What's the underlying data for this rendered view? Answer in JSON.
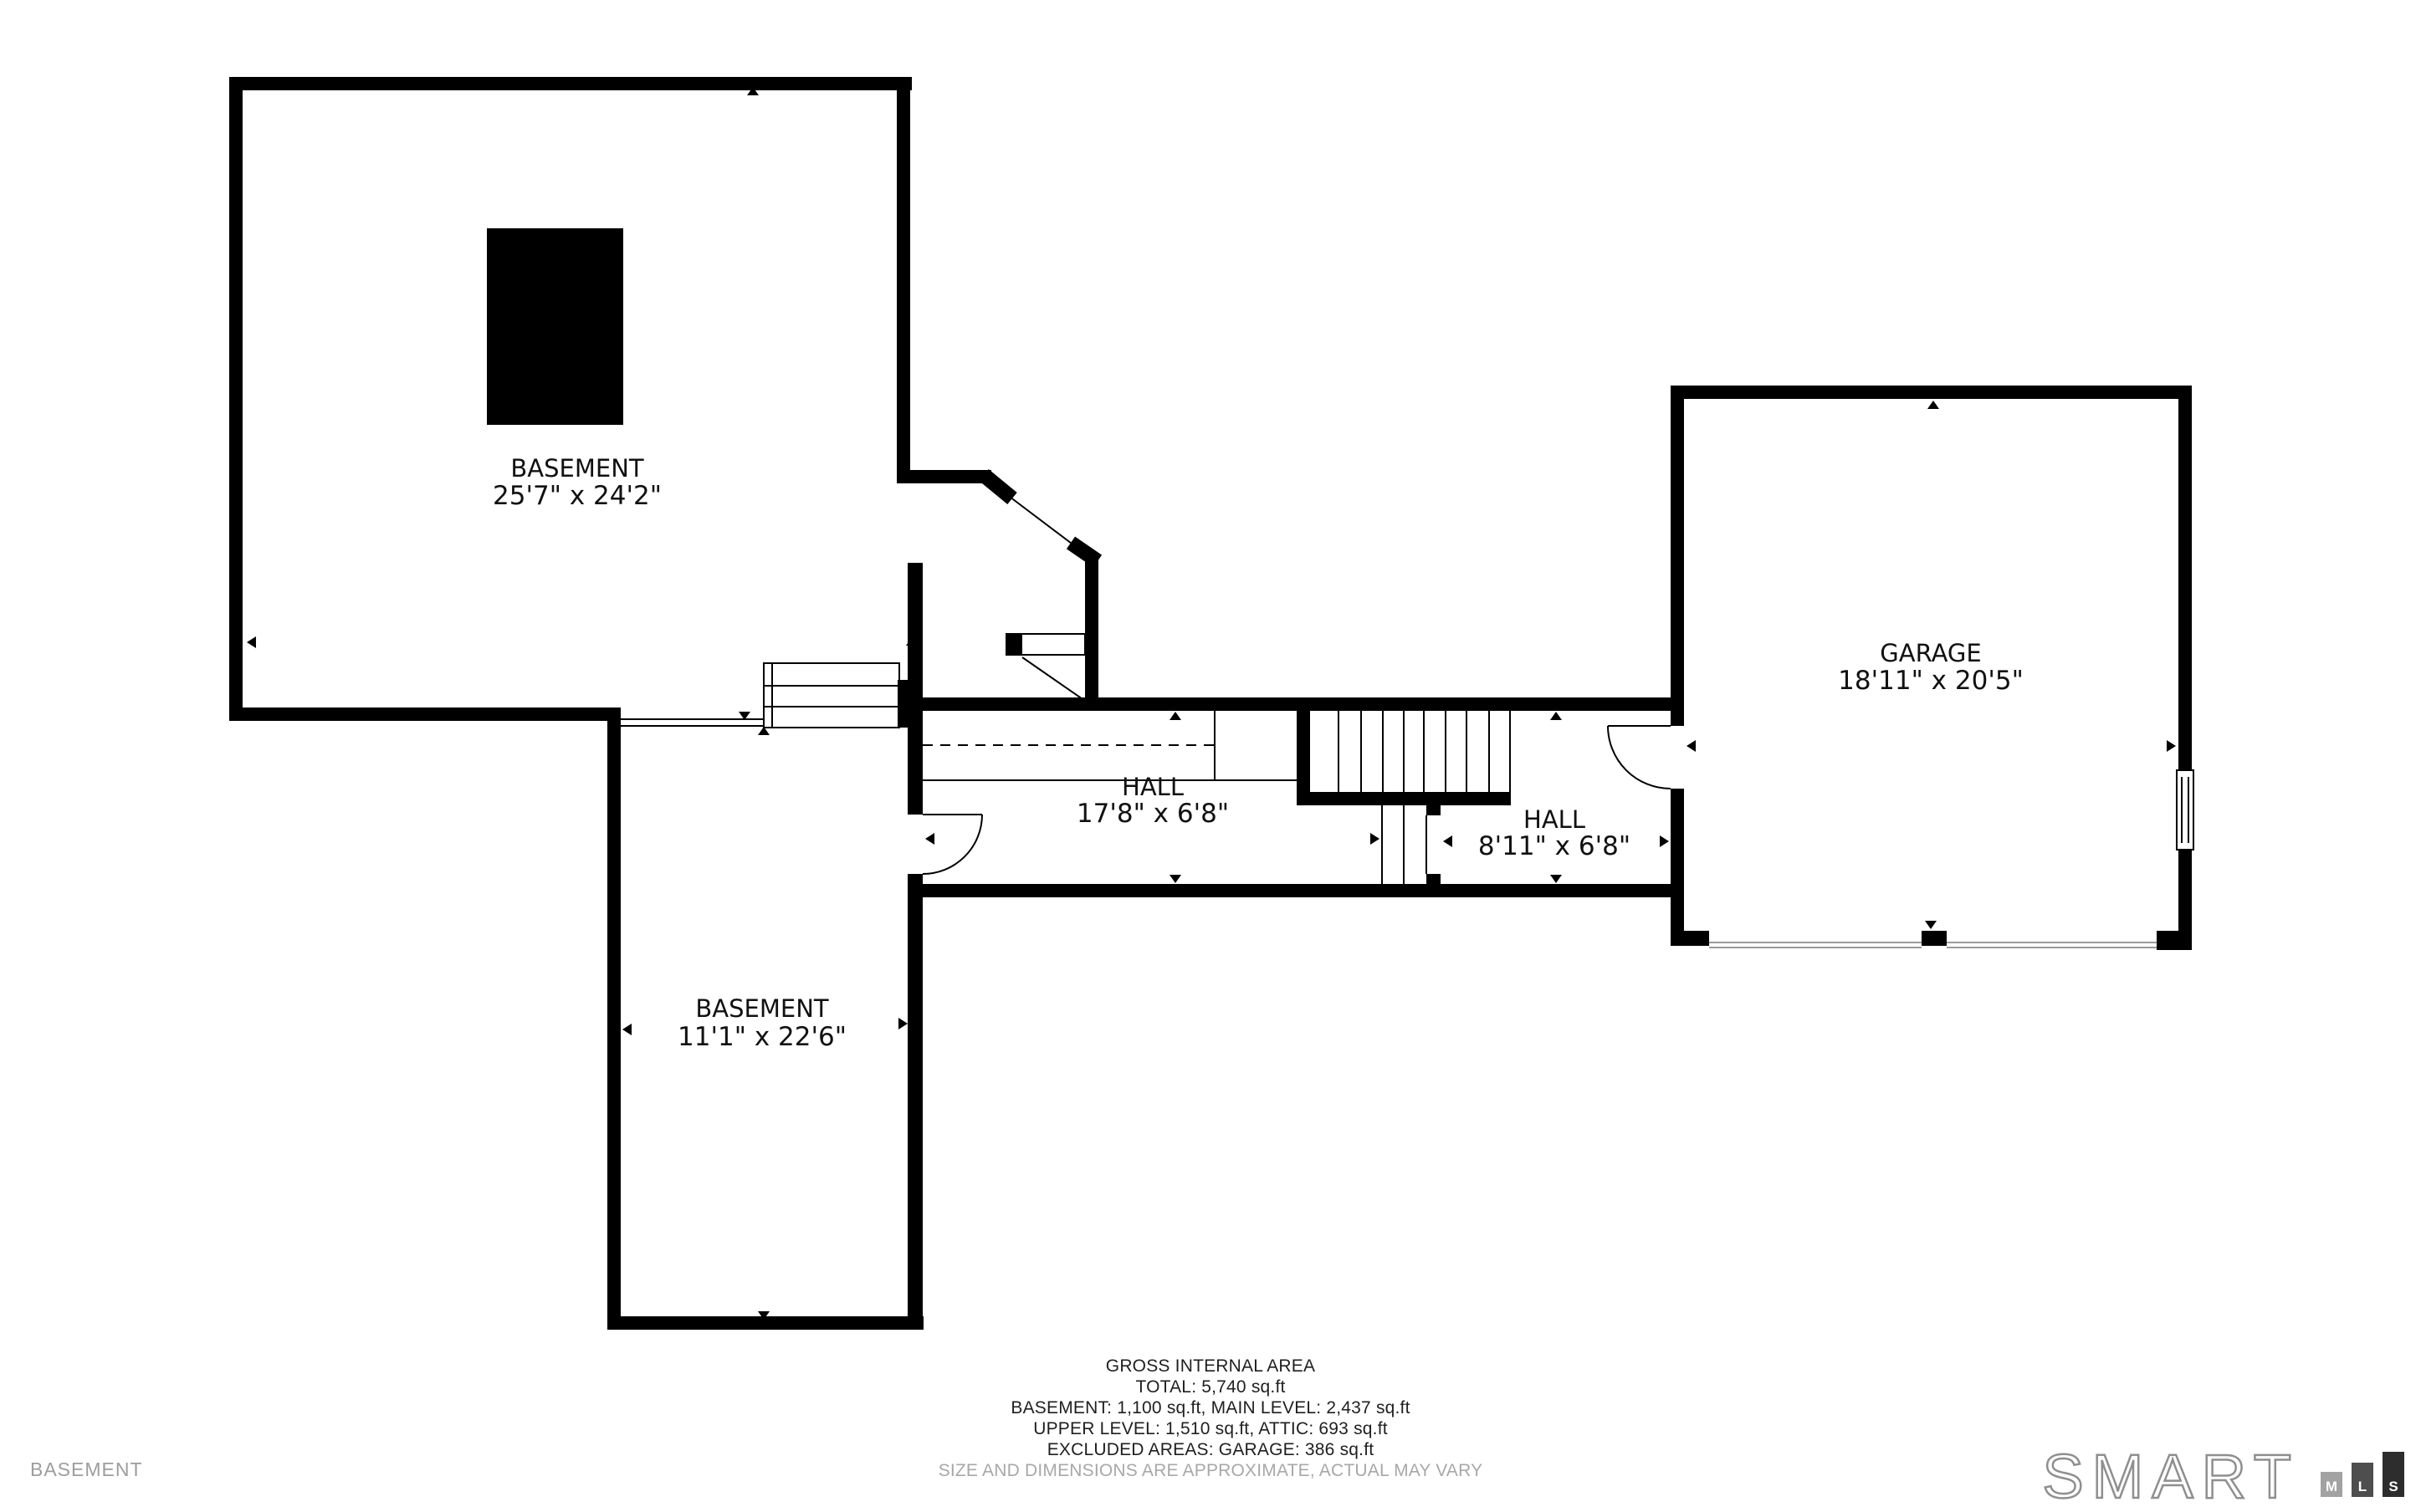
{
  "plan": {
    "level_watermark": "BASEMENT",
    "rooms": [
      {
        "name": "BASEMENT",
        "dims": "25'7\" x 24'2\""
      },
      {
        "name": "BASEMENT",
        "dims": "11'1\" x 22'6\""
      },
      {
        "name": "HALL",
        "dims": "17'8\" x 6'8\""
      },
      {
        "name": "HALL",
        "dims": "8'11\" x 6'8\""
      },
      {
        "name": "GARAGE",
        "dims": "18'11\" x 20'5\""
      }
    ]
  },
  "footer": {
    "title": "GROSS INTERNAL AREA",
    "total": "TOTAL: 5,740 sq.ft",
    "line1": "BASEMENT: 1,100 sq.ft, MAIN LEVEL: 2,437 sq.ft",
    "line2": "UPPER LEVEL: 1,510 sq.ft, ATTIC: 693 sq.ft",
    "line3": "EXCLUDED AREAS: GARAGE: 386 sq.ft",
    "disclaimer": "SIZE AND DIMENSIONS ARE APPROXIMATE, ACTUAL MAY VARY"
  },
  "logo": {
    "brand": "SMART",
    "blocks": [
      "M",
      "L",
      "S"
    ]
  },
  "colors": {
    "wall": "#000000",
    "line": "#000000",
    "opening": "#9a9a9a",
    "muted_text": "#9d9d9d",
    "footer_text": "#1f1f1f",
    "logo_outline": "#8f8f8f",
    "logo_block_m": "#a2a2a2",
    "logo_block_l": "#4e4e4e",
    "logo_block_s": "#2d2d2d"
  }
}
